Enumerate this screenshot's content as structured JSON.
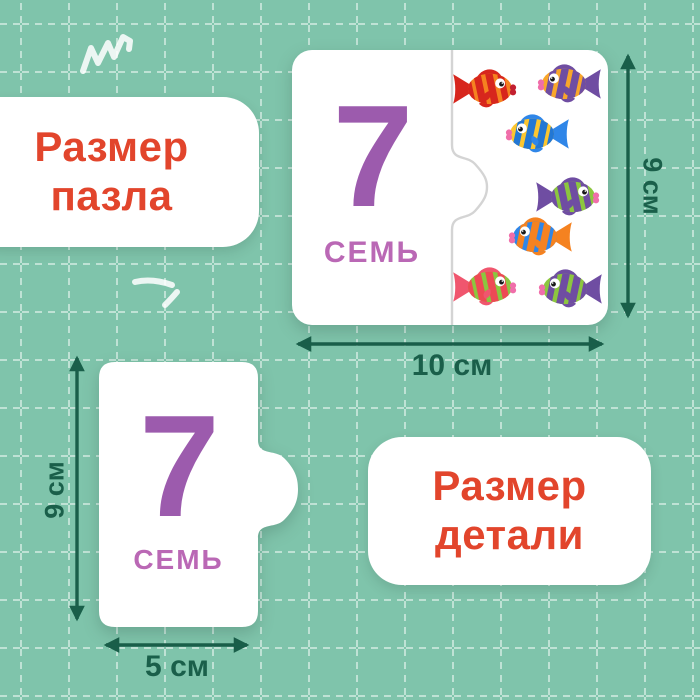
{
  "labels": {
    "puzzle_size": "Размер\nпазла",
    "part_size": "Размер\nдетали"
  },
  "puzzle_card": {
    "number": "7",
    "word": "СЕМЬ",
    "fish_count": 7,
    "fish_variants": [
      {
        "body": "#f58220",
        "stripes": "#d7261d",
        "fins": "#d7261d",
        "lips": "#c32030",
        "facing": "right"
      },
      {
        "body": "#f9a62b",
        "stripes": "#6f4da2",
        "fins": "#6f4da2",
        "lips": "#f06eaa",
        "facing": "left"
      },
      {
        "body": "#fcc62f",
        "stripes": "#2277d4",
        "fins": "#2f86e8",
        "lips": "#f06eaa",
        "facing": "left"
      },
      {
        "body": "#8cc63f",
        "stripes": "#6f4da2",
        "fins": "#6f4da2",
        "lips": "#f06eaa",
        "facing": "right"
      },
      {
        "body": "#2f86e8",
        "stripes": "#f58220",
        "fins": "#f58220",
        "lips": "#f06eaa",
        "facing": "left"
      },
      {
        "body": "#8cc63f",
        "stripes": "#ee4a55",
        "fins": "#f0566e",
        "lips": "#f06eaa",
        "facing": "right"
      },
      {
        "body": "#8cc63f",
        "stripes": "#6f4da2",
        "fins": "#6f4da2",
        "lips": "#f06eaa",
        "facing": "left"
      }
    ]
  },
  "piece_card": {
    "number": "7",
    "word": "СЕМЬ"
  },
  "dimensions": {
    "puzzle_height": "9 см",
    "puzzle_width": "10 см",
    "piece_height": "9 см",
    "piece_width": "5 см"
  },
  "colors": {
    "background": "#7fc4ab",
    "grid_line": "rgba(255,255,255,0.5)",
    "label_text": "#e2452c",
    "number_purple": "#9c5bad",
    "word_purple": "#ba68b5",
    "arrow_green": "#1a5f4a",
    "piece_white": "#ffffff",
    "seam_gray": "#d4d4d4"
  }
}
